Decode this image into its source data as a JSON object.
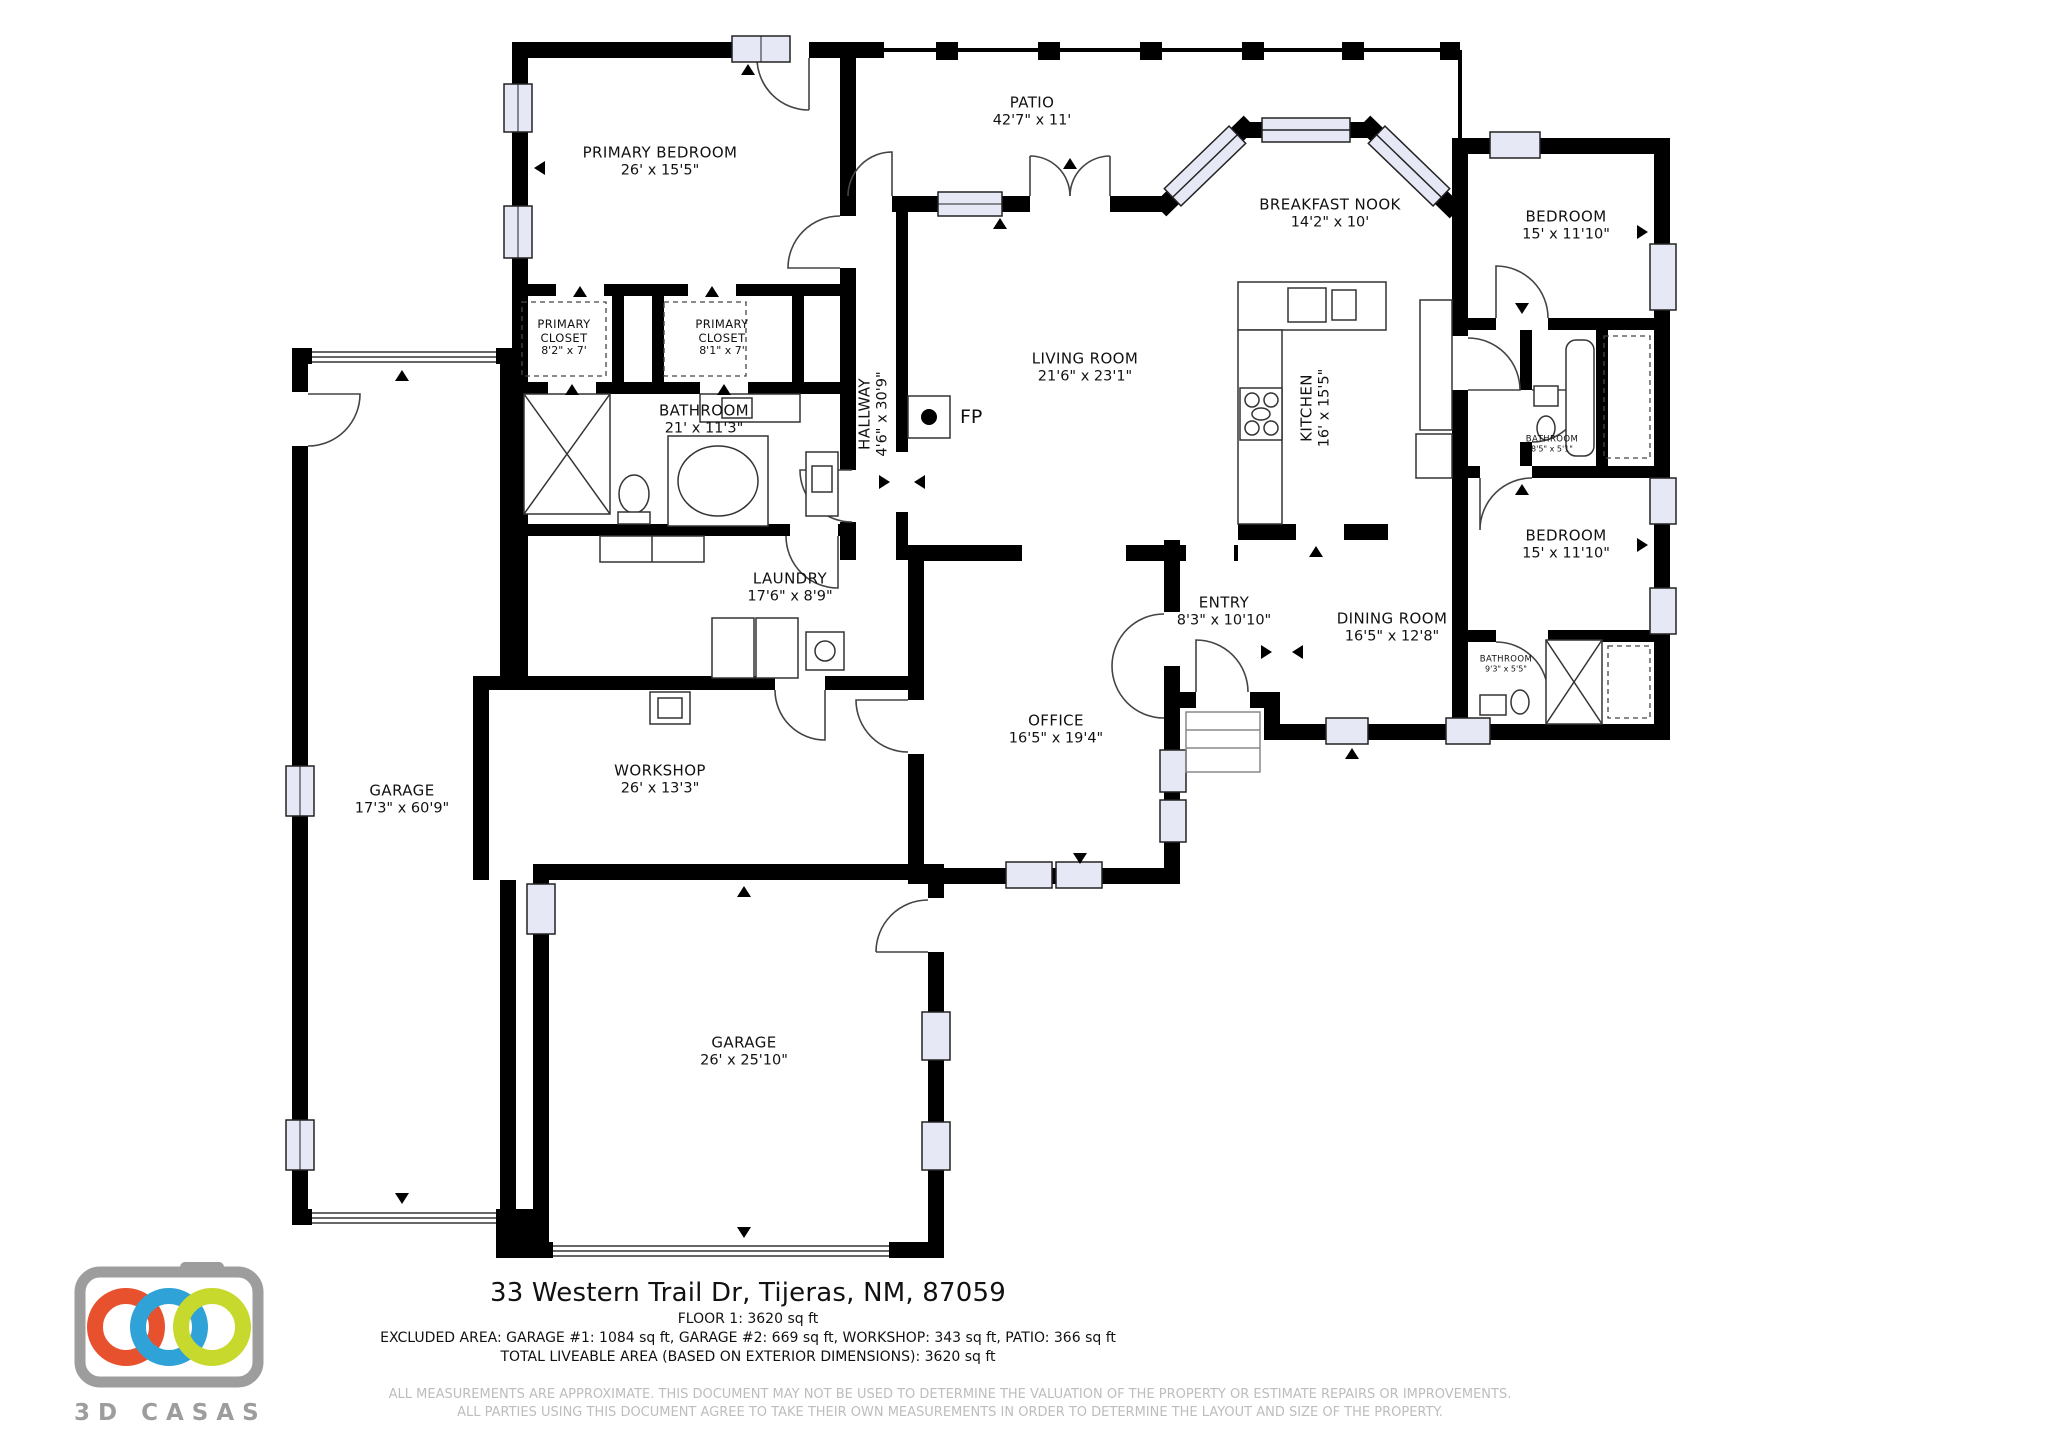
{
  "document_type": "floor-plan",
  "rooms": [
    {
      "name": "PRIMARY BEDROOM",
      "dims": "26' x 15'5\""
    },
    {
      "name": "PATIO",
      "dims": "42'7\" x 11'"
    },
    {
      "name": "BREAKFAST NOOK",
      "dims": "14'2\" x 10'"
    },
    {
      "name": "BEDROOM",
      "dims": "15' x 11'10\""
    },
    {
      "name": "PRIMARY CLOSET",
      "dims": "8'2\" x 7'"
    },
    {
      "name": "PRIMARY CLOSET",
      "dims": "8'1\" x 7'"
    },
    {
      "name": "HALLWAY",
      "dims": "4'6\" x 30'9\""
    },
    {
      "name": "LIVING ROOM",
      "dims": "21'6\" x 23'1\""
    },
    {
      "name": "KITCHEN",
      "dims": "16' x 15'5\""
    },
    {
      "name": "BATHROOM",
      "dims": "21' x 11'3\""
    },
    {
      "name": "BATHROOM",
      "dims": "8'5\" x 5'1\""
    },
    {
      "name": "BEDROOM",
      "dims": "15' x 11'10\""
    },
    {
      "name": "LAUNDRY",
      "dims": "17'6\" x 8'9\""
    },
    {
      "name": "ENTRY",
      "dims": "8'3\" x 10'10\""
    },
    {
      "name": "DINING ROOM",
      "dims": "16'5\" x 12'8\""
    },
    {
      "name": "BATHROOM",
      "dims": "9'3\" x 5'5\""
    },
    {
      "name": "OFFICE",
      "dims": "16'5\" x 19'4\""
    },
    {
      "name": "GARAGE",
      "dims": "17'3\" x 60'9\""
    },
    {
      "name": "WORKSHOP",
      "dims": "26' x 13'3\""
    },
    {
      "name": "GARAGE",
      "dims": "26' x 25'10\""
    }
  ],
  "fireplace": {
    "label": "FP"
  },
  "footer": {
    "address": "33 Western Trail Dr, Tijeras, NM, 87059",
    "floor_line": "FLOOR 1: 3620 sq ft",
    "excluded_line": "EXCLUDED AREA: GARAGE #1: 1084 sq ft, GARAGE #2: 669 sq ft, WORKSHOP: 343 sq ft, PATIO: 366 sq ft",
    "total_line": "TOTAL LIVEABLE AREA (BASED ON EXTERIOR DIMENSIONS): 3620 sq ft",
    "disclaimer1": "ALL MEASUREMENTS ARE APPROXIMATE. THIS DOCUMENT MAY NOT BE USED TO DETERMINE THE VALUATION OF THE PROPERTY OR ESTIMATE REPAIRS OR IMPROVEMENTS.",
    "disclaimer2": "ALL PARTIES USING THIS DOCUMENT AGREE TO TAKE THEIR OWN MEASUREMENTS IN ORDER TO DETERMINE THE LAYOUT AND SIZE OF THE PROPERTY."
  },
  "logo": {
    "text": "3D CASAS",
    "colors": {
      "orange": "#e8512e",
      "blue": "#2fa3d7",
      "green": "#c8d92e",
      "gray": "#9d9d9d"
    }
  },
  "colors": {
    "wall": "#000000",
    "window_fill": "#e6e9f5",
    "disclaimer_gray": "#bdbdbd"
  }
}
